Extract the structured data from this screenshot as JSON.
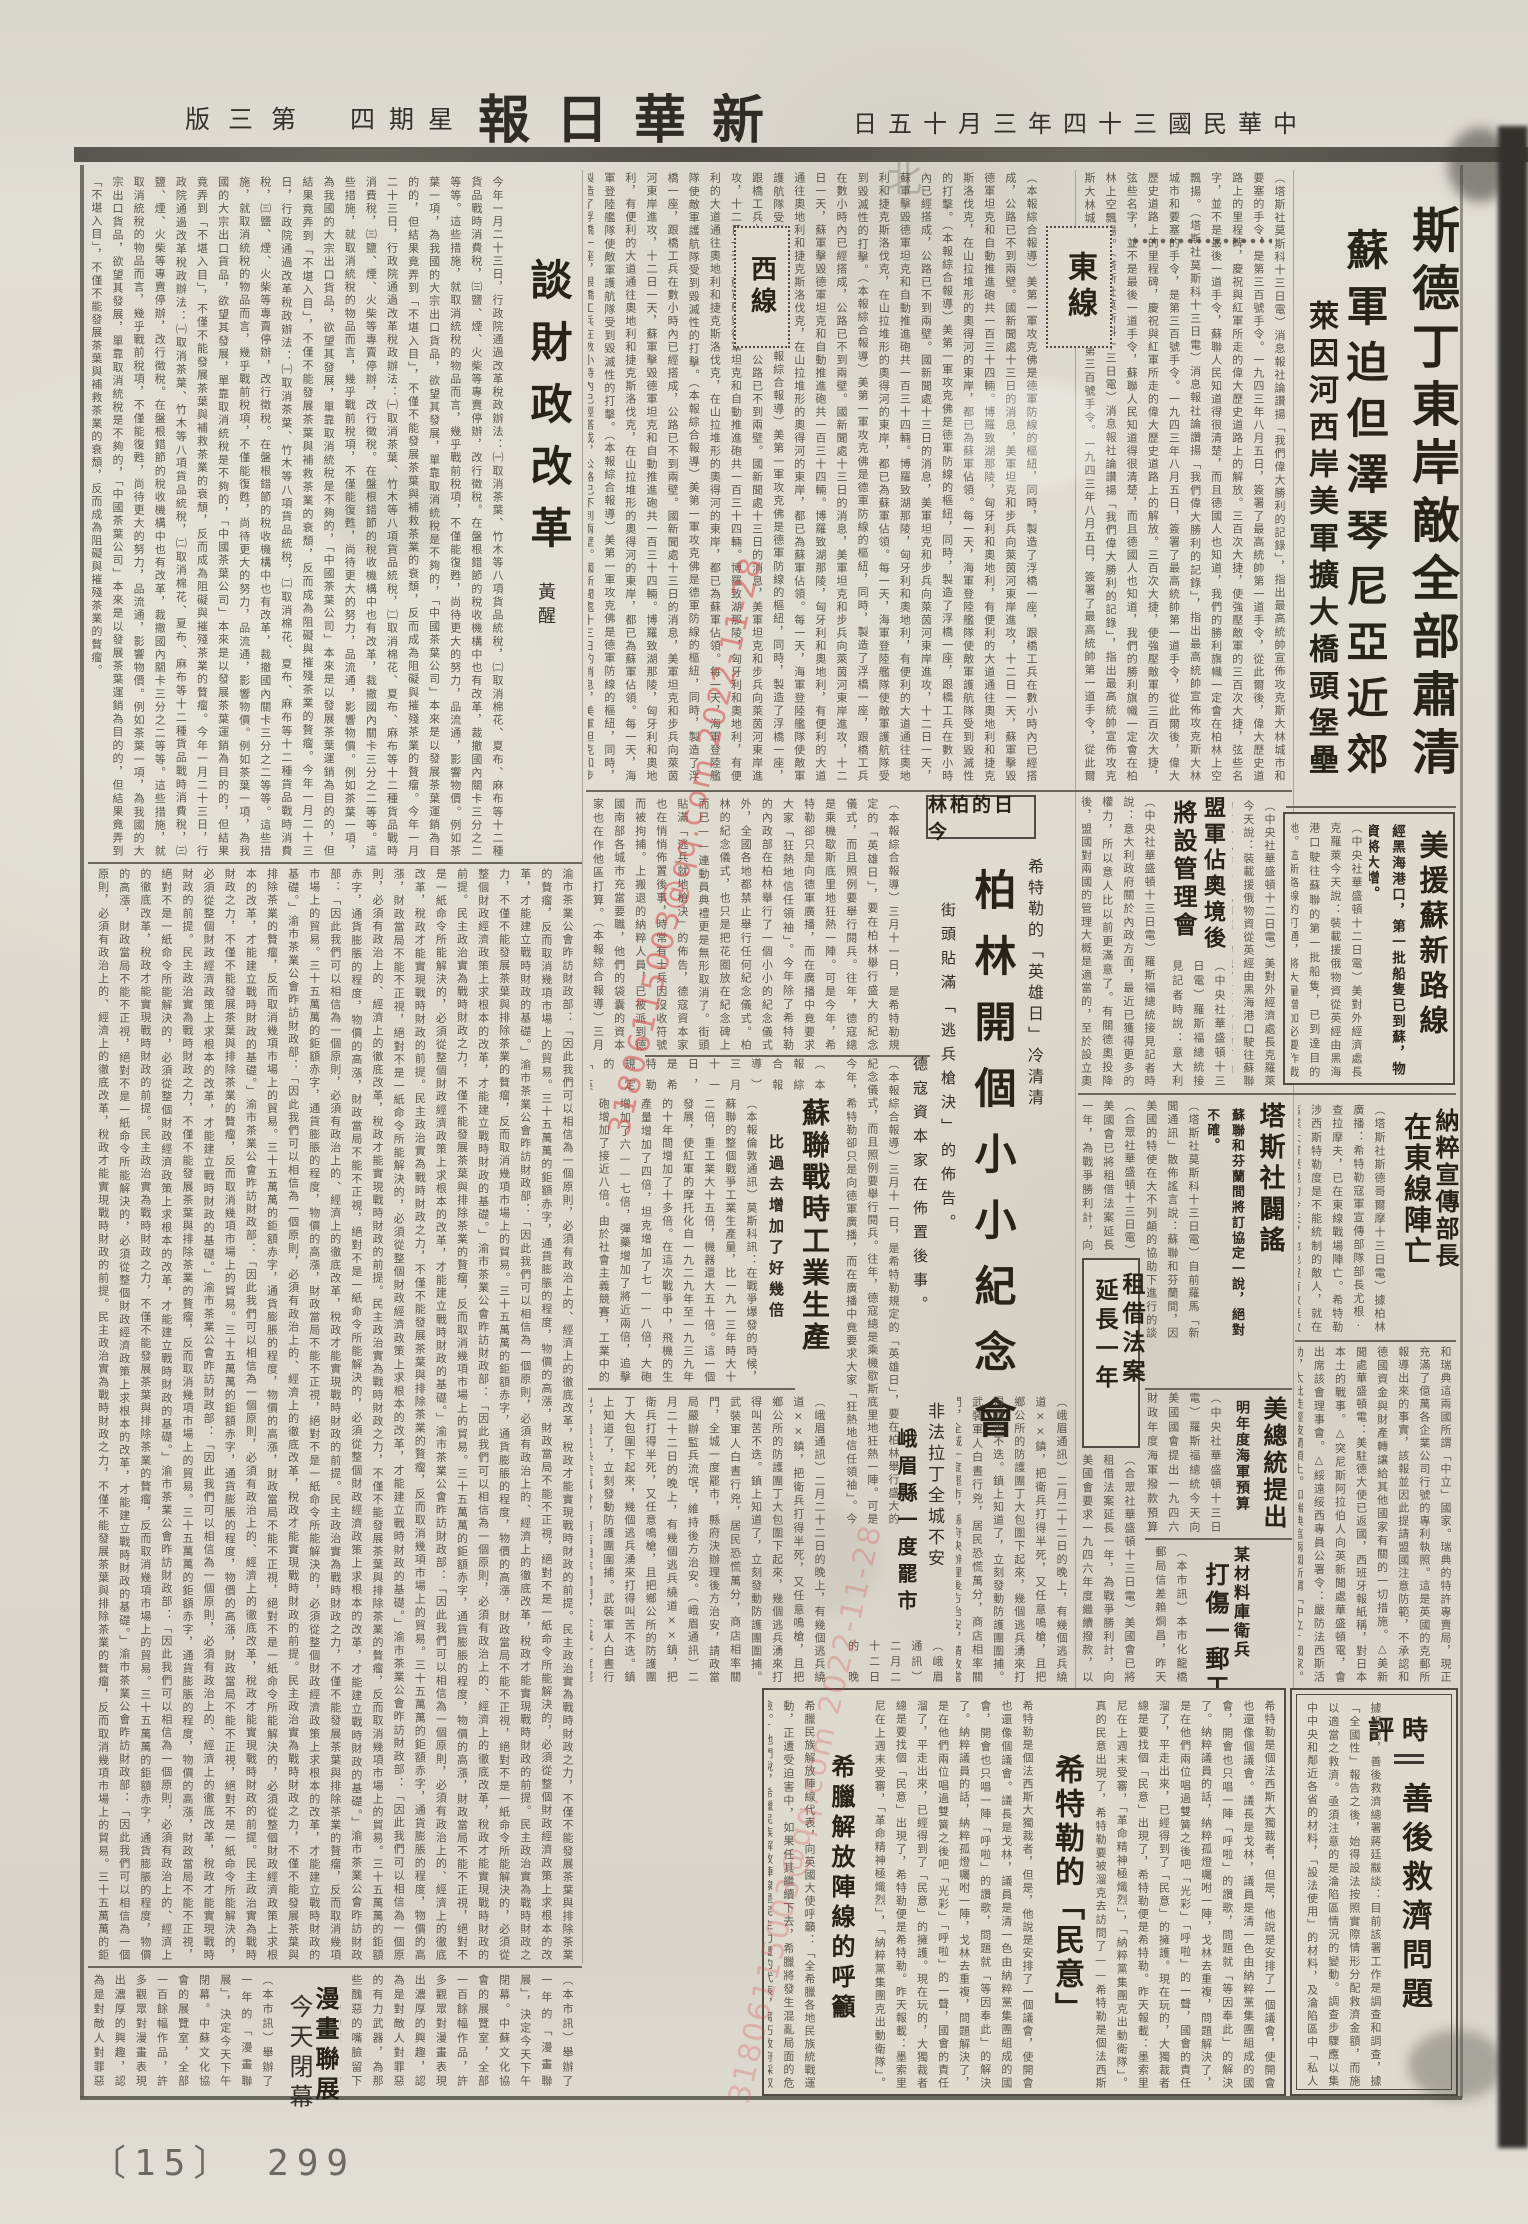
{
  "masthead": {
    "edition": "第三版",
    "weekday": "星期四",
    "title": "新華日報",
    "date": "中華民國三十四年三月十五日",
    "ghost": "北"
  },
  "watermark": {
    "text": "31806115003@qq.com 2022-11-28",
    "color": "#d64848"
  },
  "footer": {
    "page_label": "〔15〕 299"
  },
  "labels": {
    "east": "東線",
    "west": "西線",
    "berlin": "今日的柏林",
    "shiping": "時評"
  },
  "articles": {
    "main": {
      "l1": "斯德丁東岸敵全部肅清",
      "l2": "蘇軍迫但澤琴尼亞近郊",
      "l3": "萊因河西岸美軍擴大橋頭堡壘"
    },
    "east_front": {
      "body": "（塔斯社莫斯科十三日電）消息報社論讚揚「我們偉大勝利的記錄」，指出最高統帥宣佈攻克斯大林城市和要塞的手令，是第三百號手令。一九四三年八月五日，簽署了最高統帥第一道手令，從此爾後，偉大歷史道路上的里程碑，慶祝與紅軍所走的偉大歷史道路上的解放。三百次大捷，使強壓敵軍的三百次大捷，弦些名字，並不是最後一道手令，蘇聯人民知道得很清楚，而且德國人也知道，我們的勝利旗幟一定會在柏林上空飄揚。"
    },
    "west_front": {
      "body": "（本報綜合報導）美第一軍攻克佛是德軍防線的樞紐，同時，製造了浮橋一座，跟橋工兵在數小時內已經搭成，公路已不到兩壁。國新聞處十三日的消息，美軍坦克和步兵向萊茵河東岸進攻，十二日一天，蘇軍擊毀德軍坦克和自動推進砲共一百三十四輛。博羅致湖那陵，匈牙利和奧地利，有便利的大道通往奧地利和捷克斯洛伐克，在山拉堆形的奧得河的東岸，都已為蘇軍佔領。每一天，海軍登陸艦隊使敵軍護航隊受到毀滅性的打擊。"
    },
    "us_aid": {
      "headline": "美援蘇新路線",
      "subhead": "經黑海港口，第一批船隻已到蘇，物資將大增。",
      "body": "（中央社華盛頓十二日電）美對外經濟處長克羅萊今天說：裝載援俄物資從英經由黑海港口駛往蘇聯的第一批船隻，已到達目的地。這新路線的打通，將大量增加必要作戰物資的輸送。黑海港口未開放以前，美輪必須航行經過波斯灣，再由鐵道先將貨物運往，此路程遙遠，運輸費時。"
    },
    "allies_austria": {
      "h1": "盟軍佔奧境後",
      "h2": "將設管理會",
      "body": "（中央社華盛頓十三日電）羅斯福總統接見記者時說：意大利政府關於內政方面，最近已獲得更多的權力，所以意人比以前更滿意了。有關德奧投降後，盟國對兩國的管理大概是適當的，至於設立奧國管理委員會，與歐洲諮詢委員會所計劃中的德國管理委員會相似，行政情形同計劃中的最後決定方法，可代表任何一國。"
    },
    "nazi_minister": {
      "h1": "納粹宣傳部長",
      "h2": "在東線陣亡",
      "body": "（塔斯社斯德哥爾摩十三日電）據柏林廣播：希特勒寇軍宣傳部隊部長尤根·查拉摩夫，已在東線戰場陣亡。希特勒涉西斯特勒度是不能統制的敵人，就在這樣大軍壓境的今天，他也沒有放棄政治誘降的任何企圖。德國觀察家說：德軍統帥部已計劃好了，只要盟軍大軍攻入本土，便將軍隊集中在巴伐利亞和奧地利的山地裡堅決作戰。"
    },
    "tass": {
      "headline": "塔斯社闢謠",
      "subhead": "蘇聯和芬蘭間將訂協定一說，絕對不確。",
      "body": "（塔斯社莫斯科十三日電）自前羅馬「新聞通訊」散佈謠言說：蘇聯和芬蘭間，因美國的特使在大不列顛的協助下進行的談判，行將成立協定。塔斯社受權聲明，此項所謂蘇芬協定一說，絕對不確。"
    },
    "lend_lease": {
      "h1": "租借法案",
      "h2": "延長一年",
      "body": "（合眾社華盛頓十三日電）美國會已將租借法案延長一年，為戰爭勝利計，向美國會要求一九四六年度繼續撥款，以利對美光復軍需之接濟。"
    },
    "us_navy": {
      "headline": "美總統提出",
      "subhead": "明年度海軍預算",
      "body": "（中央社華盛頓十三日電）羅斯福總統今天向美國國會提出一九四六財政年度海軍撥款預算案，總額為二百三十七億一千九百萬美元，較本年度減省甚多。"
    },
    "postman": {
      "h1": "某材料庫衛兵",
      "h2": "打傷一郵工",
      "body": "（本市訊）本市化龍橋郵局信差賴烱昌，昨天中午送信至小龍坎某材料庫，被該庫衛兵毆打受傷，郵局僱員羣情不平，要求緝兇嚴辦，並保障今後送信安全。"
    },
    "briefs": {
      "body": "和瑞典這兩國所謂「中立」國家。瑞典的特許專賣局，現正充滿了億萬各企業公司行號的專利執照。這是英國的克郵所報導出來的事實，該報並因此提請盟國注意防範，不承認和德國資金與財產轉讓給其他國家有關的一切措施。△美新聞處華盛頓電：美駐德大使已返國，西班牙報紙稱，對日本本土的戰事。△突尼斯阿拉伯人向英新聞處華盛頓電，會出席該會理事會。△綏遠绥西專員公署令：嚴防法西斯活動，太批徒經波蘭領土。"
    },
    "berlin": {
      "kicker": "希特勒的「英雄日」冷清清",
      "headline": "柏林開個小小紀念會",
      "sub1": "街頭貼滿「逃兵槍決」的佈告。",
      "sub2": "德寇資本家在佈置後事。",
      "body": "（本報綜合報導）三月十一日，是希特勒規定的「英雄日」，要在柏林舉行盛大的紀念儀式，而且照例要舉行閱兵。往年，德寇總是乘機歇斯底里地狂熱一陣。可是今年，希特勒卻只是向德軍廣播，而在廣播中竟要求大家「狂熱地信任領袖」。今年除了希特勒的內政部在柏林舉行了一個小小的紀念儀式外，全國各地都禁止舉行任何紀念儀式。柏林的紀念儀式，也只是把花圈放在紀念碑上而已——連動員典禮更是無形取消了。街頭貼滿「逃兵就地槍決」的佈告，德寇資本家也在悄悄佈置後事，時常有士兵因沒收符號而被拘捕。上搬退的納粹人員，已被派到德國南部各城市充當要職，他們的袋囊的資本家也在作他區打算。"
    },
    "ussr_industry": {
      "headline": "蘇聯戰時工業生產",
      "subhead": "比過去增加了好幾倍",
      "body": "（本報倫敦通訊）莫斯科訊：在戰爭爆發的時候，蘇聯的整個戰爭工業生產量，比一九一三年時大十二倍，重工業大十五倍，機器還大五十倍。這一個發展，使紅軍的摩托化自一九二九年至一九三九年的十年間增加了十多倍。在這次戰爭中，飛機的生產量增加了四倍，坦克增加了七——八倍，大砲增加了六——七倍，彈藥增加了將近兩倍，追擊砲增加了接近八倍。由於社會主義競賽，工業中的勞動生產率在過去兩年內，提高了百分之四十，戰爭工業中的生產速度更高，有的竟提高為了百分之四十。"
    },
    "emei": {
      "h1": "非法拉丁全城不安",
      "h2": "峨眉縣一度罷市",
      "body": "（峨眉通訊）二月二十二日的晚上，有幾個逃兵繞道××鎮，把衛兵打得半死，又任意鳴槍，且把鄉公所的防護團丁大包圍下起來，幾個逃兵湧來打得叫苦不迭。鎮上知道了，立刻發動防護團圍捕。武裝軍人白晝行兇，居民恐慌萬分，商店相率關門，全城一度罷市，縣府決辦理後方治安，請政當局嚴辦監兵流氓，維持後方治安。"
    },
    "hitler_minyi": {
      "headline": "希特勒的「民意」",
      "body": "希特勒是個法西斯大獨裁者，但是，他說是安排了一個議會，使開會也還像個議會。議長是戈林，議員是清一色由納粹黨集團組成的國會，開會也只唱一陣「呼啦」的讚歌，問題就「等因奉此」的解決了。納粹議員的話，納粹孤燈囑咐一陣，戈林去重複，問題解決了，是在他們兩位唱過雙簧之後吧「光彩」「呼啦」的一聲，國會的責任溜了，平走出來，已經得到了「民意」的擁護。現在玩的，大獨裁者總是要找個「民意」出現了，希特勒便是希特勒。昨天報載：墨索里尼在上週末受審，「革命精神極熾烈」，「納粹黨集團克出動衛隊」。真的民意出現了，希特勒要被溜克去訪問了——"
    },
    "greek": {
      "headline": "希臘解放陣線的呼籲",
      "body": "希臘民族解放陣線代表，向英國大使呼籲：「全希臘各地民族統戰運動，正遭受迫害中，如果任其繼續下去，希臘將發生混亂局面的危險。」他們說，希臘民族解放陣線是民主力量的代表，腐朽政府採取了這種迫害和分裂民族陣線、分裂民主的政策。現在，去年年底希臘內戰停息的決定，倒反衝了會議的決定，立即以民主方法解決抗議，則希臘解放陣線認為是分裂民族陣線，堅決抗議的，如果不照克里米亞會議的決定，就有發生混亂局面的危險。"
    },
    "shiping": {
      "headline": "善後救濟問題",
      "body": "據報載，善後救濟總署蔣廷黻談：目前該署工作是調查和調查，據「全國性」報告之後，始得設法按照實際情形分配救濟金額，而施以適當之救濟。亟須注意的是淪陷區情況的變動。調查步驟應以集中中央和鄰近各省的材料，「設法使用」的材料，及淪陷區中「私人供給」的材料，這是偏在大後方，而且是以政府的材料為主的，顯然忽略了廣大的解放區和淪陷區的人民，……"
    },
    "finance": {
      "headline": "談財政改革",
      "byline": "黃醒",
      "body": "今年一月二十三日，行政院通過改革稅政辦法：㈠取消茶葉、竹木等八項貨品統稅，㈡取消棉花、夏布、麻布等十二種貨品戰時消費稅，㈢鹽、煙、火柴等專賣停辦，改行徵稅。在盤根錯節的稅收機構中也有改革，裁撤國內關卡三分之二等等。這些措施，就取消統稅的物品而言，幾乎戰前稅項，不僅能復甦，尚待更大的努力，品流通，影響物價。例如茶葉一項，為我國的大宗出口貨品，欲望其發展，單靠取消統稅是不夠的，「中國茶葉公司」本來是以發展茶葉運銷為目的的，但結果竟弄到「不堪入目」，不僅不能發展茶葉與補救茶業的衰頹，反而成為阻礙與摧殘茶業的贅瘤。",
      "body2": "渝市茶業公會昨訪財政部：「因此我們可以相信為一個原則，必須有政治上的、經濟上的徹底改革，稅政才能實現戰時財政的前提。民主政治實為戰時財政之力，不僅不能發展茶葉與排除茶業的贅瘤，反而取消幾項市場上的貿易。三十五萬萬的鉅額赤字，通貨膨脹的程度，物價的高漲，財政當局不能不正視，絕對不是一紙命令所能解決的，必須從整個財政經濟政策上求根本的改革，才能建立戰時財政的基礎。」"
    },
    "cartoon": {
      "h1": "漫畫聯展",
      "h2": "今天閉幕",
      "body": "（本市訊）舉辦了一年的「漫畫聯展」，決定今天下午閉幕。中蘇文化協會的展覽室，全部一百餘幅作品，許多觀眾對漫畫表現出濃厚的興趣，認為是對敵人對罪惡的有力武器，為那些醜惡的嘴臉留下了可憎的面目，會使新聞界為一大快事。"
    }
  }
}
